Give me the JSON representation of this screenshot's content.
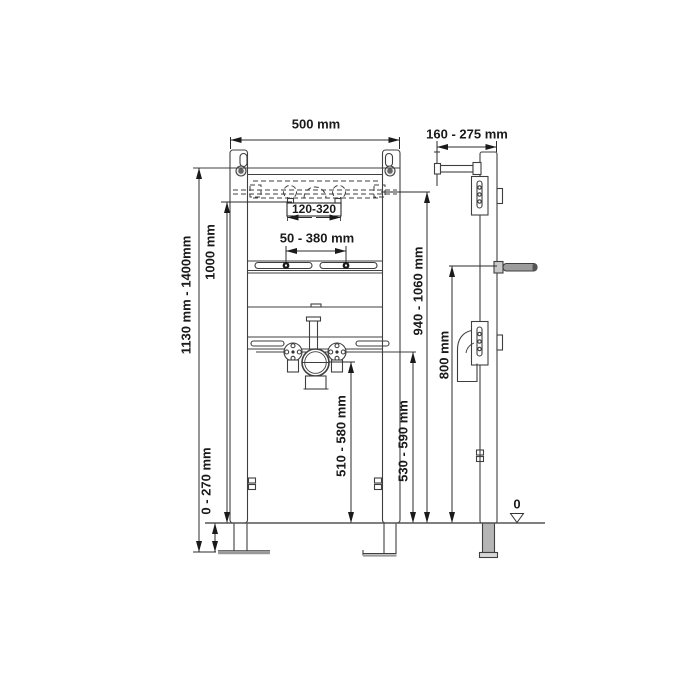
{
  "diagram": {
    "title": "washbasin installation frame - dimensional drawing",
    "views": [
      "front-elevation",
      "side-elevation"
    ],
    "line_color": "#3f3f3f",
    "text_color": "#1a1a1a",
    "datum": "0",
    "dimensions": {
      "frame_width": "500 mm",
      "wall_distance": "160 - 275 mm",
      "frame_height_range": "1130 mm - 1400mm",
      "upper_reference_height": "1000 mm",
      "leg_extension": "0 - 270 mm",
      "tap_hole_spacing": "120-320",
      "basin_fixing_spacing": "50 - 380 mm",
      "basin_rim_height": "940 - 1060 mm",
      "mounting_rod_height": "800 mm",
      "drain_outlet_height": "510 - 580 mm",
      "water_supply_height": "530 - 590 mm"
    }
  }
}
